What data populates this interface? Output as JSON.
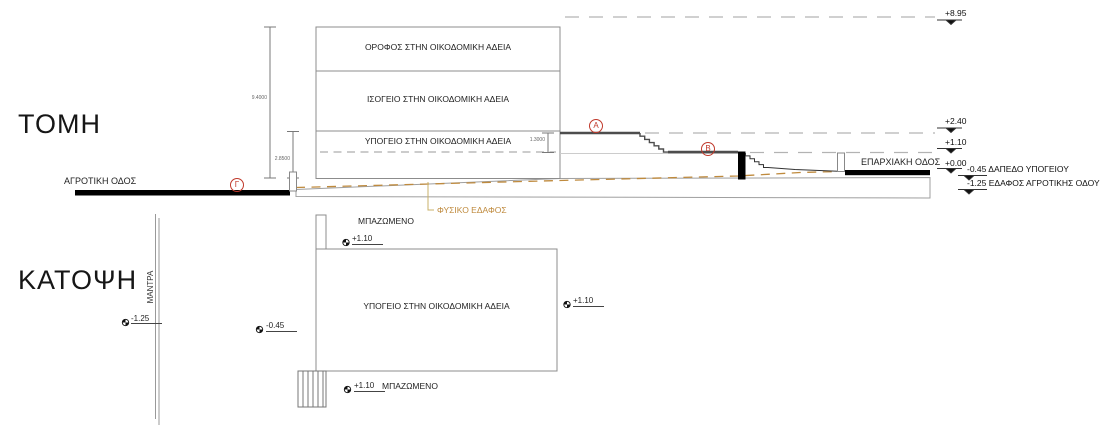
{
  "section": {
    "title": "ΤΟΜΗ",
    "floors": [
      "ΟΡΟΦΟΣ ΣΤΗΝ ΟΙΚΟΔΟΜΙΚΗ ΑΔΕΙΑ",
      "ΙΣΟΓΕΙΟ ΣΤΗΝ ΟΙΚΟΔΟΜΙΚΗ ΑΔΕΙΑ",
      "ΥΠΟΓΕΙΟ ΣΤΗΝ ΟΙΚΟΔΟΜΙΚΗ ΑΔΕΙΑ"
    ],
    "dimensions": {
      "overall_height": "9.4000",
      "basement_height": "2.8500",
      "retaining_step": "1.3000"
    },
    "levels": {
      "top": "+8.95",
      "upper": "+2.40",
      "middle": "+1.10",
      "road": "+0.00"
    },
    "notes": [
      {
        "value": "-0.45",
        "label": "ΔΑΠΕΔΟ ΥΠΟΓΕΙΟΥ"
      },
      {
        "value": "-1.25",
        "label": "ΕΔΑΦΟΣ ΑΓΡΟΤΙΚΗΣ ΟΔΟΥ"
      }
    ],
    "road_left": "ΑΓΡΟΤΙΚΗ ΟΔΟΣ",
    "road_right": "ΕΠΑΡΧΙΑΚΗ ΟΔΟΣ",
    "points": {
      "a": "A",
      "b": "B",
      "c": "Γ"
    },
    "natural_ground": "ΦΥΣΙΚΟ ΕΔΑΦΟΣ"
  },
  "plan": {
    "title": "ΚΑΤΟΨΗ",
    "room": "ΥΠΟΓΕΙΟ ΣΤΗΝ ΟΙΚΟΔΟΜΙΚΗ ΑΔΕΙΑ",
    "fence": "ΜΑΝΤΡΑ",
    "fill_top": "ΜΠΑΖΩΜΕΝΟ",
    "fill_bottom": "ΜΠΑΖΩΜΕΝΟ",
    "spots": {
      "fence": "-1.25",
      "top": "+1.10",
      "left": "-0.45",
      "right": "+1.10",
      "bottom": "+1.10"
    }
  },
  "colors": {
    "natural_ground": "#bf8a3d",
    "marker_red": "#c0392b",
    "line_gray": "#8c8c8c"
  }
}
